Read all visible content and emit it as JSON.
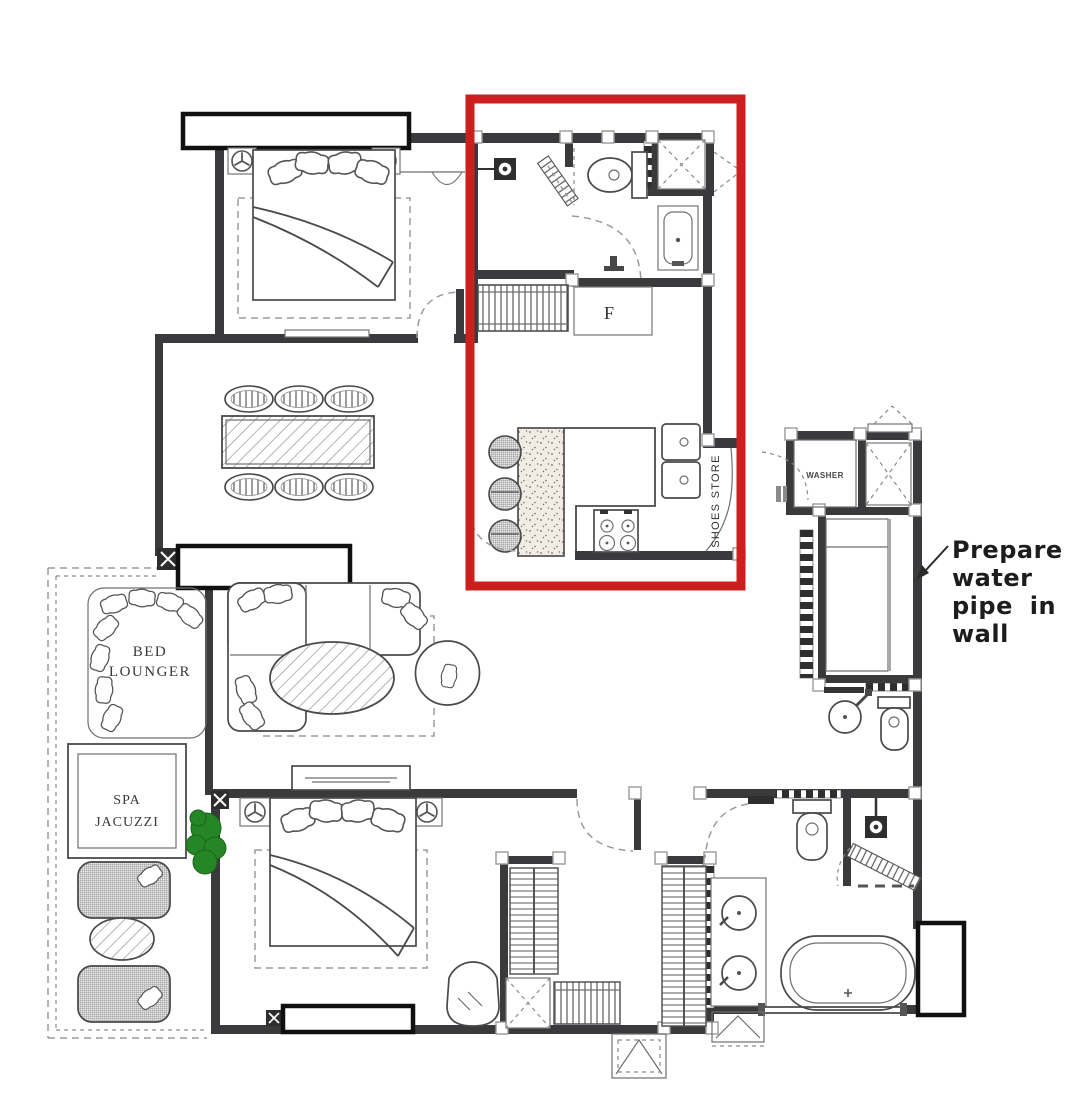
{
  "floor_plan": {
    "highlight_box_color": "#ce1f1f",
    "wall_color": "#3a3a3c",
    "plant_color": "#268626"
  },
  "labels": {
    "bed_lounger": [
      "BED",
      "LOUNGER"
    ],
    "spa_jacuzzi": [
      "SPA",
      "JACUZZI"
    ],
    "washer": "WASHER",
    "shoes_store": "SHOES STORE",
    "fridge": "F",
    "water_pipe_note": [
      "Prepare",
      "water",
      "pipe in",
      "wall"
    ]
  }
}
